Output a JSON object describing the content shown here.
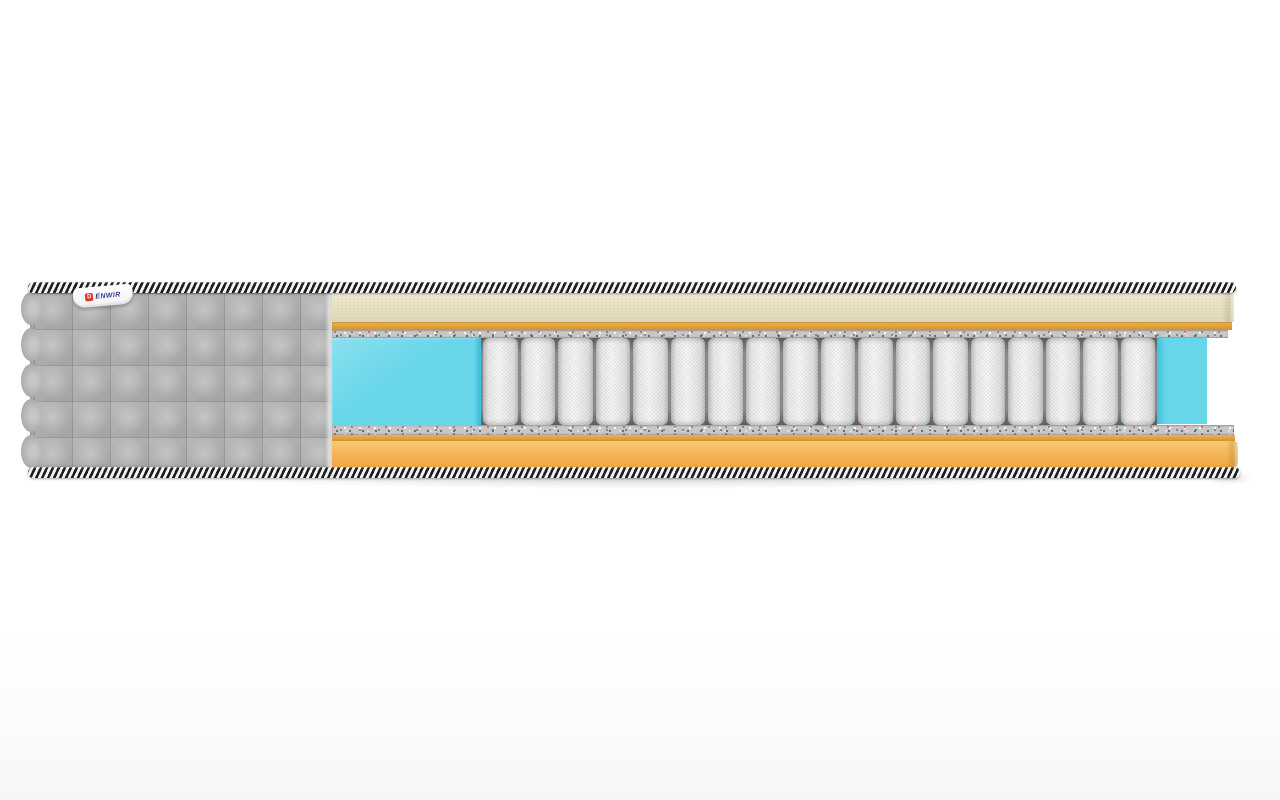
{
  "image": {
    "description": "3D cutaway product render of a mattress on a white background showing internal layers",
    "background": "#ffffff"
  },
  "label": {
    "brand_mark": "D",
    "brand_text": "ENWIR"
  },
  "mattress": {
    "cover": {
      "quilt_rows": 5,
      "quilt_cols": 8,
      "scallop_bumps": 5
    },
    "springs_count": 18
  },
  "colors": {
    "shadow": "rgba(0,0,0,0.16)",
    "piping-dark": "#1e1e1e",
    "piping-light": "#f3f3f3",
    "cover-gray": "#b1b1b1",
    "cover-gray-light": "#c6c6c6",
    "cover-gray-dark": "#989898",
    "cream": "#e9e1c0",
    "orange-line": "#e2a13c",
    "orange-line-light": "#eeb253",
    "orange-line-dark": "#d2922e",
    "felt": "#c7c7c7",
    "blue": "#68d6e9",
    "blue-light": "#8ae0ef",
    "blue-side": "#42c0d8",
    "spring-face": "#fafafa",
    "spring-edge": "#c2c2c2",
    "spring-cavity": "#8a8a8a",
    "spring-cavity-dark": "#5c5c5c",
    "base-orange": "#f7b85c",
    "base-orange-light": "#fac971",
    "base-orange-dark": "#eca945",
    "label-red": "#e03528",
    "label-blue": "#2c3f8e"
  }
}
